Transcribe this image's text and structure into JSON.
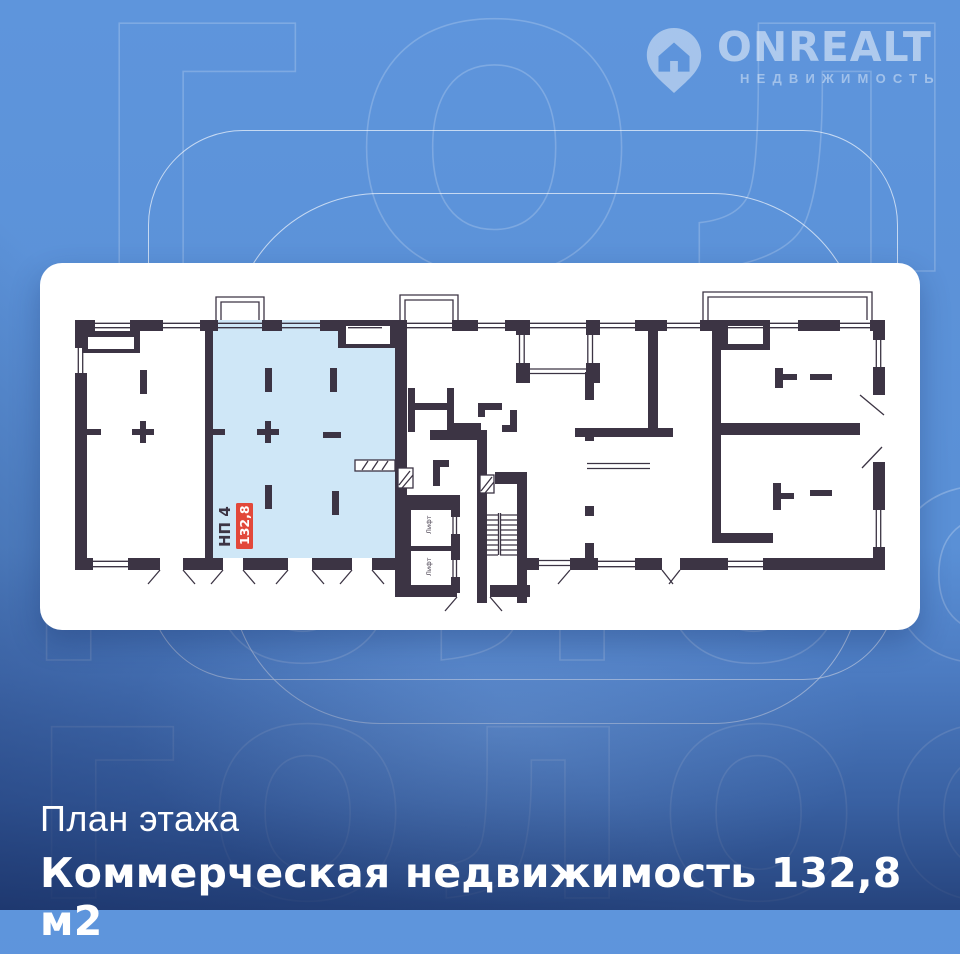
{
  "watermark": {
    "text": "ГОЛОС"
  },
  "logo": {
    "brand": "ONREALT",
    "subtitle": "НЕДВИЖИМОСТЬ"
  },
  "plan": {
    "unit_label": "НП 4",
    "unit_area": "132,8",
    "elevator_label": "Лифт",
    "colors": {
      "wall": "#3c3444",
      "highlight": "#cfe7f7",
      "badge": "#e2483a"
    }
  },
  "caption": {
    "title": "План этажа",
    "subtitle": "Коммерческая недвижимость 132,8 м2"
  }
}
